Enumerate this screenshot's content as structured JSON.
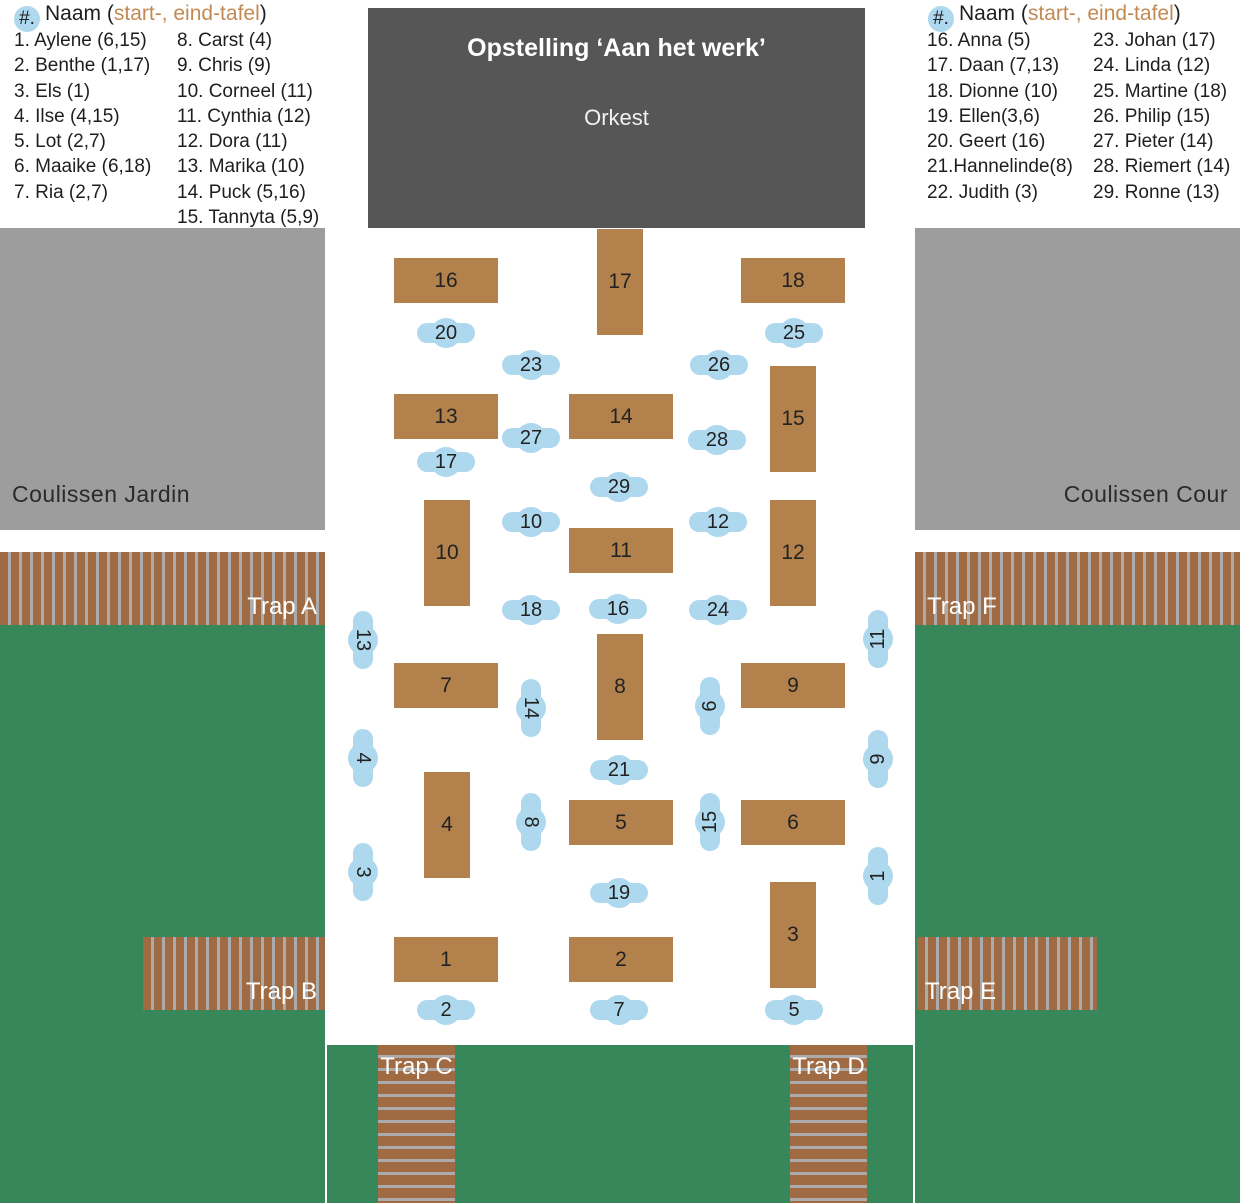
{
  "colors": {
    "table": "#b3814c",
    "trapbrown": "#a06b43",
    "stripe": "#ababab",
    "green": "#38875a",
    "gray": "#9d9d9d",
    "dark": "#565656",
    "blue": "#aed8ee",
    "orange": "#c28a52",
    "ink": "#1e1e1e"
  },
  "stage": {
    "title": "Opstelling ‘Aan het werk’",
    "orchestra_label": "Orkest"
  },
  "areas": {
    "coulissen_jardin": "Coulissen Jardin",
    "coulissen_cour": "Coulissen Cour"
  },
  "traps": {
    "a": "Trap A",
    "b": "Trap B",
    "c": "Trap C",
    "d": "Trap D",
    "e": "Trap E",
    "f": "Trap F"
  },
  "legend_left": {
    "header": {
      "badge": "#.",
      "pre": "Naam (",
      "highlight": "start-, eind-tafel",
      "post": ")"
    },
    "col1": [
      "1. Aylene (6,15)",
      "2. Benthe (1,17)",
      "3. Els (1)",
      "4. Ilse (4,15)",
      "5. Lot (2,7)",
      "6. Maaike (6,18)",
      "7. Ria (2,7)"
    ],
    "col2": [
      "8. Carst (4)",
      "9. Chris (9)",
      "10. Corneel (11)",
      "11. Cynthia (12)",
      "12. Dora (11)",
      "13. Marika (10)",
      "14. Puck (5,16)",
      "15. Tannyta (5,9)"
    ]
  },
  "legend_right": {
    "header": {
      "badge": "#.",
      "pre": "Naam (",
      "highlight": "start-, eind-tafel",
      "post": ")"
    },
    "col1": [
      "16. Anna (5)",
      "17. Daan (7,13)",
      "18. Dionne (10)",
      "19. Ellen(3,6)",
      "20. Geert (16)",
      "21.Hannelinde(8)",
      "22. Judith (3)"
    ],
    "col2": [
      "23. Johan (17)",
      "24. Linda (12)",
      "25. Martine (18)",
      "26. Philip (15)",
      "27. Pieter (14)",
      "28. Riemert (14)",
      "29. Ronne (13)"
    ]
  },
  "tables": [
    {
      "n": "16",
      "x": 394,
      "y": 258,
      "o": "h"
    },
    {
      "n": "17",
      "x": 597,
      "y": 229,
      "o": "v"
    },
    {
      "n": "18",
      "x": 741,
      "y": 258,
      "o": "h"
    },
    {
      "n": "13",
      "x": 394,
      "y": 394,
      "o": "h"
    },
    {
      "n": "14",
      "x": 569,
      "y": 394,
      "o": "h"
    },
    {
      "n": "15",
      "x": 770,
      "y": 366,
      "o": "v"
    },
    {
      "n": "10",
      "x": 424,
      "y": 500,
      "o": "v"
    },
    {
      "n": "11",
      "x": 569,
      "y": 528,
      "o": "h"
    },
    {
      "n": "12",
      "x": 770,
      "y": 500,
      "o": "v"
    },
    {
      "n": "7",
      "x": 394,
      "y": 663,
      "o": "h"
    },
    {
      "n": "8",
      "x": 597,
      "y": 634,
      "o": "v"
    },
    {
      "n": "9",
      "x": 741,
      "y": 663,
      "o": "h"
    },
    {
      "n": "4",
      "x": 424,
      "y": 772,
      "o": "v"
    },
    {
      "n": "5",
      "x": 569,
      "y": 800,
      "o": "h"
    },
    {
      "n": "6",
      "x": 741,
      "y": 800,
      "o": "h"
    },
    {
      "n": "1",
      "x": 394,
      "y": 937,
      "o": "h"
    },
    {
      "n": "2",
      "x": 569,
      "y": 937,
      "o": "h"
    },
    {
      "n": "3",
      "x": 770,
      "y": 882,
      "o": "v"
    }
  ],
  "persons": [
    {
      "n": "20",
      "x": 446,
      "y": 333,
      "r": 0
    },
    {
      "n": "25",
      "x": 794,
      "y": 333,
      "r": 0
    },
    {
      "n": "23",
      "x": 531,
      "y": 365,
      "r": 0
    },
    {
      "n": "26",
      "x": 719,
      "y": 365,
      "r": 0
    },
    {
      "n": "27",
      "x": 531,
      "y": 438,
      "r": 0
    },
    {
      "n": "28",
      "x": 717,
      "y": 440,
      "r": 0
    },
    {
      "n": "17",
      "x": 446,
      "y": 462,
      "r": 0
    },
    {
      "n": "29",
      "x": 619,
      "y": 487,
      "r": 0
    },
    {
      "n": "10",
      "x": 531,
      "y": 522,
      "r": 0
    },
    {
      "n": "12",
      "x": 718,
      "y": 522,
      "r": 0
    },
    {
      "n": "18",
      "x": 531,
      "y": 610,
      "r": 0
    },
    {
      "n": "16",
      "x": 618,
      "y": 609,
      "r": 0
    },
    {
      "n": "24",
      "x": 718,
      "y": 610,
      "r": 0
    },
    {
      "n": "13",
      "x": 363,
      "y": 640,
      "r": 90
    },
    {
      "n": "11",
      "x": 878,
      "y": 639,
      "r": -90
    },
    {
      "n": "14",
      "x": 531,
      "y": 708,
      "r": 90
    },
    {
      "n": "6",
      "x": 710,
      "y": 706,
      "r": -90
    },
    {
      "n": "4",
      "x": 363,
      "y": 758,
      "r": 90
    },
    {
      "n": "9",
      "x": 878,
      "y": 759,
      "r": -90
    },
    {
      "n": "21",
      "x": 619,
      "y": 770,
      "r": 0
    },
    {
      "n": "8",
      "x": 531,
      "y": 822,
      "r": 90
    },
    {
      "n": "15",
      "x": 710,
      "y": 822,
      "r": -90
    },
    {
      "n": "3",
      "x": 363,
      "y": 872,
      "r": 90
    },
    {
      "n": "1",
      "x": 878,
      "y": 876,
      "r": -90
    },
    {
      "n": "19",
      "x": 619,
      "y": 893,
      "r": 0
    },
    {
      "n": "2",
      "x": 446,
      "y": 1010,
      "r": 0
    },
    {
      "n": "7",
      "x": 619,
      "y": 1010,
      "r": 0
    },
    {
      "n": "5",
      "x": 794,
      "y": 1010,
      "r": 0
    }
  ]
}
